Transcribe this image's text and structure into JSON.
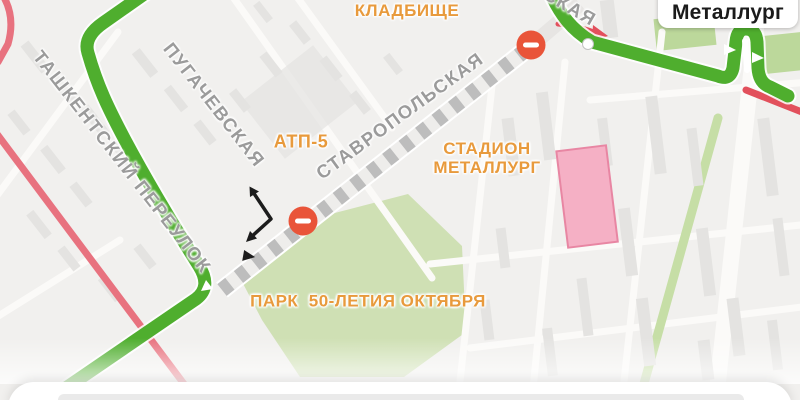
{
  "map": {
    "poi_labels": {
      "cemetery": {
        "line1": "БЕЗЫМЯНСКОЕ",
        "line2": "КЛАДБИЩЕ"
      },
      "atp": "АТП-5",
      "stadium": {
        "line1": "СТАДИОН",
        "line2": "МЕТАЛЛУРГ"
      },
      "park": "ПАРК  50-ЛЕТИЯ ОКТЯБРЯ"
    },
    "street_labels": {
      "tashkentsky": "ТАШКЕНТСКИЙ ПЕРЕУЛОК",
      "pugachevskaya": "ПУГАЧЕВСКАЯ",
      "stavropolskaya": "СТАВРОПОЛЬСКАЯ",
      "partial_top": "СКАЯ"
    },
    "transit_stop": {
      "label": "Металлург"
    },
    "colors": {
      "map_background": "#f1f0ee",
      "route_green": "#4fae2e",
      "closed_road_pink": "#e8727f",
      "road_red": "#e2505c",
      "no_entry_sign": "#e95439",
      "poi_orange": "#e89a3c",
      "street_gray": "#9b9b9b",
      "park_green": "#cfe0b4"
    }
  }
}
